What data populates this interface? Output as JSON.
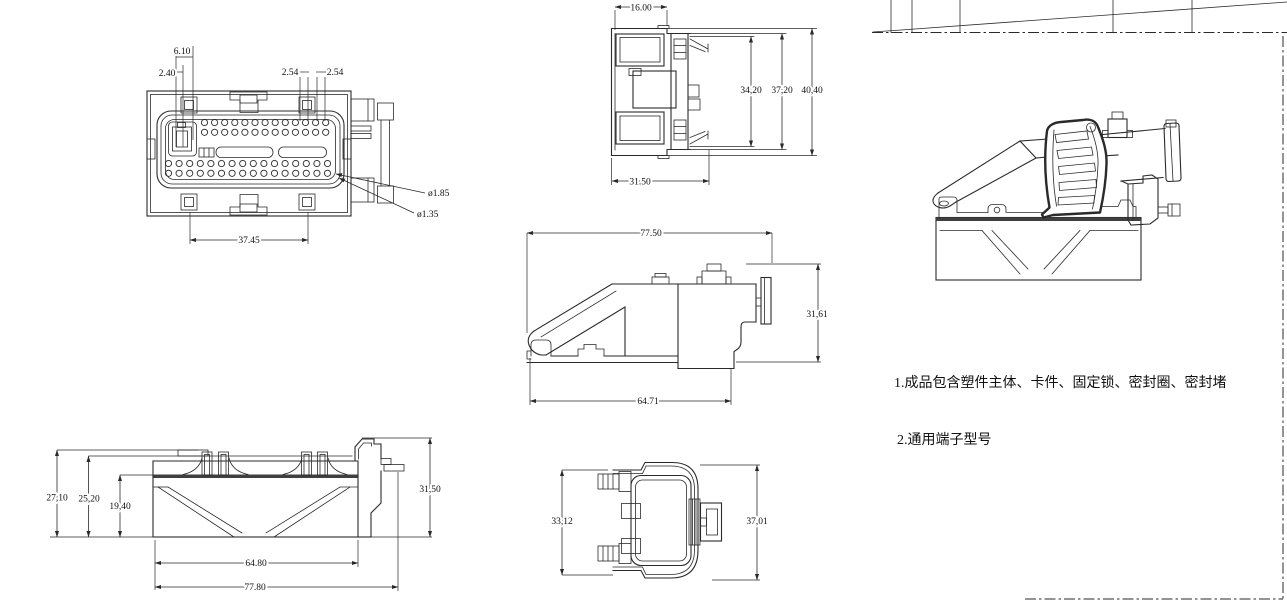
{
  "colors": {
    "line": "#2a2a2a",
    "background": "#ffffff"
  },
  "notes": {
    "note1": "1.成品包含塑件主体、卡件、固定锁、密封圈、密封堵",
    "note2": "2.通用端子型号"
  },
  "views": {
    "front": {
      "dims": {
        "d610": "6.10",
        "d240": "2.40",
        "d254a": "2.54",
        "d254b": "2.54",
        "dia185": "ø1.85",
        "dia135": "ø1.35",
        "d3745": "37.45"
      }
    },
    "side_section": {
      "dims": {
        "d1600": "16.00",
        "d3420": "34,20",
        "d3720": "37,20",
        "d4040": "40,40",
        "d3150": "31.50"
      }
    },
    "side_profile": {
      "dims": {
        "d7750": "77.50",
        "d3161": "31,61",
        "d6471": "64.71"
      }
    },
    "front_profile": {
      "dims": {
        "d2710": "27,10",
        "d2520": "25,20",
        "d1940": "19,40",
        "d3150": "31,50",
        "d6480": "64.80",
        "d7780": "77.80"
      }
    },
    "rear": {
      "dims": {
        "d3312": "33,12",
        "d3701": "37,01"
      }
    }
  }
}
